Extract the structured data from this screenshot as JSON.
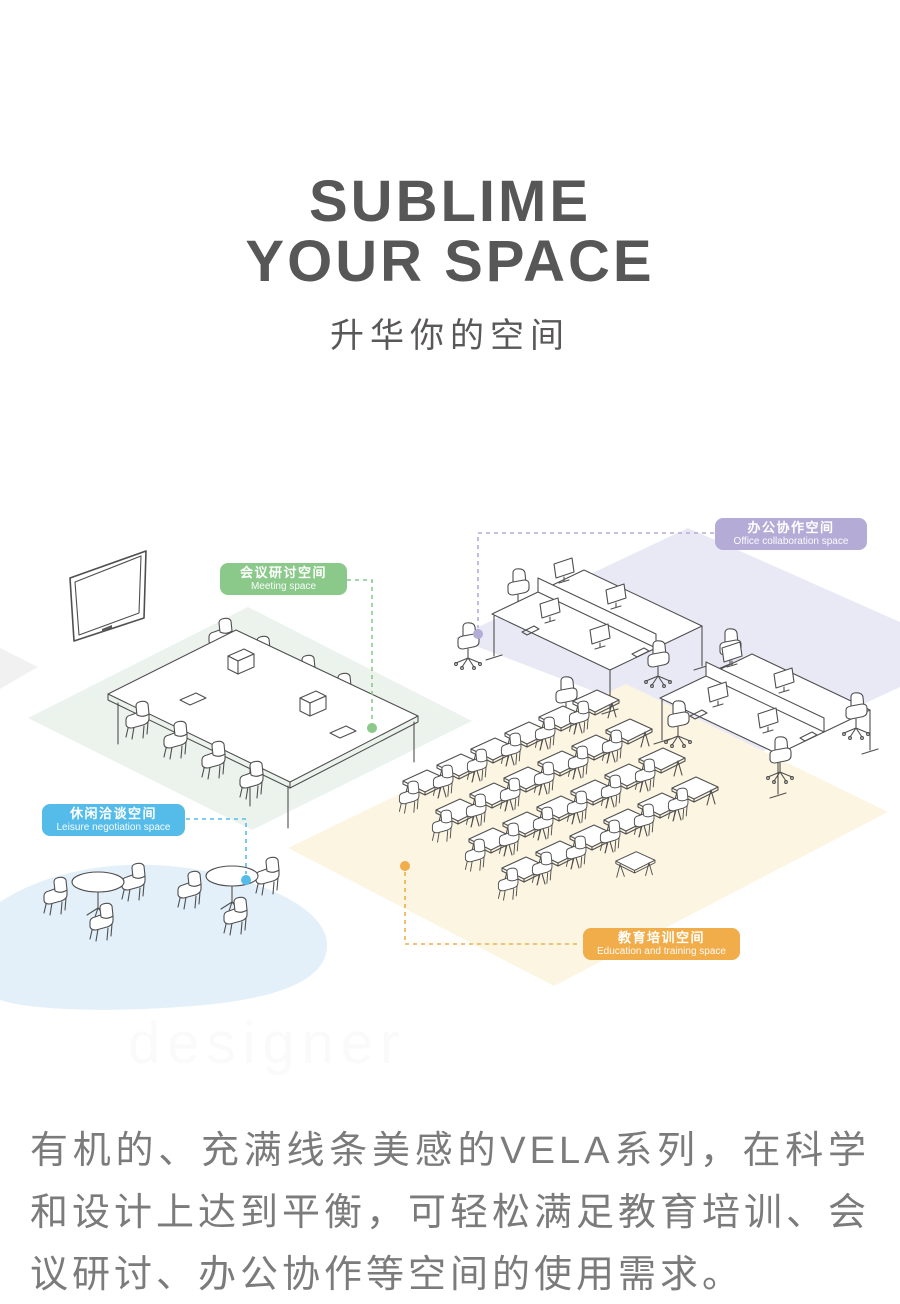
{
  "header": {
    "title_line1": "SUBLIME",
    "title_line2": "YOUR SPACE",
    "subtitle": "升华你的空间"
  },
  "watermark": "designer",
  "labels": {
    "meeting": {
      "cn": "会议研讨空间",
      "en": "Meeting space",
      "color": "#8bc98b"
    },
    "office": {
      "cn": "办公协作空间",
      "en": "Office collaboration space",
      "color": "#b5abd7"
    },
    "leisure": {
      "cn": "休闲洽谈空间",
      "en": "Leisure negotiation space",
      "color": "#55bce9"
    },
    "education": {
      "cn": "教育培训空间",
      "en": "Education and training space",
      "color": "#f0ad4a"
    }
  },
  "colors": {
    "title_text": "#575757",
    "body_text": "#7b7b7b",
    "line_art": "#4f4f4f",
    "meeting": "#8bc98b",
    "office": "#b5abd7",
    "leisure": "#55bce9",
    "education": "#f0ad4a",
    "floor_meeting": "#ecf3ed",
    "floor_office": "#e9e9f6",
    "floor_leisure": "#e3f0f9",
    "floor_education": "#fcf5e2",
    "floor_misc": "#f1f1f1"
  },
  "description": "有机的、充满线条美感的VELA系列，在科学和设计上达到平衡，可轻松满足教育培训、会议研讨、办公协作等空间的使用需求。"
}
